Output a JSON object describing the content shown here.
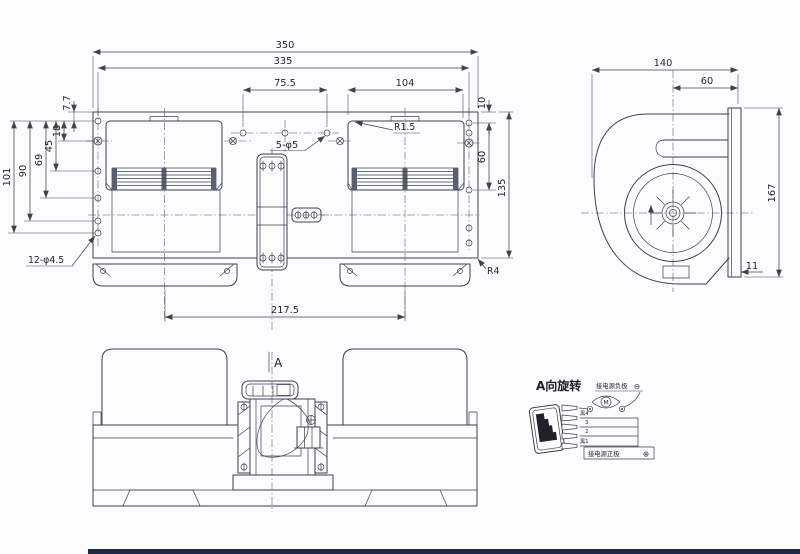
{
  "top_view": {
    "dims": {
      "overall": "350",
      "holes_span": "335",
      "center_holes": "75.5",
      "right_housing": "104",
      "edge_offset": "10",
      "right_mid": "60",
      "plate_height": "135",
      "feet_span": "217.5",
      "v7_7": "7.7",
      "v18": "18",
      "v45": "45",
      "v69": "69",
      "v90": "90",
      "v101": "101"
    },
    "notes": {
      "holes12": "12-φ4.5",
      "holes5": "5-φ5",
      "r15": "R1.5",
      "r4": "R4"
    }
  },
  "side_view": {
    "dims": {
      "width": "140",
      "outlet_offset": "60",
      "height": "167",
      "flange": "11"
    }
  },
  "front_view": {
    "section_label": "A"
  },
  "wiring": {
    "title": "A向旋转",
    "negative_label": "接电源负极",
    "negative_symbol": "⊖",
    "positive_label": "接电源正极",
    "positive_symbol": "⊕",
    "motor_symbol": "M",
    "wire_labels": [
      "黑4",
      "3",
      "2",
      "黑1"
    ]
  },
  "colors": {
    "line": "#39414e",
    "background": "#fbfcfe",
    "footer_bar": "#16294a"
  }
}
